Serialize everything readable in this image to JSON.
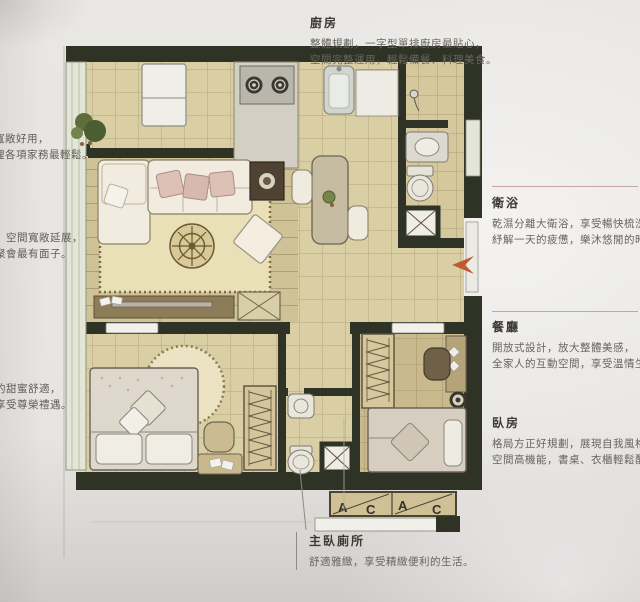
{
  "annotations": {
    "kitchen": {
      "title": "廚房",
      "line1": "整體規劃，一字型單排廚房最貼心，",
      "line2": "空間完整運用，輕鬆備餐、料理美食。"
    },
    "bathroom": {
      "title": "衛浴",
      "line1": "乾濕分離大衛浴，享受暢快梳洗，",
      "line2": "紓解一天的疲憊，樂沐悠閒的時光。"
    },
    "dining": {
      "title": "餐廳",
      "line1": "開放式設計，放大整體美感，",
      "line2": "全家人的互動空間，享受溫情生活。"
    },
    "bedroom": {
      "title": "臥房",
      "line1": "格局方正好規劃，展現自我風格，",
      "line2": "空間高機能，書桌、衣櫃輕鬆配置。"
    },
    "master_toilet": {
      "title": "主臥廁所",
      "line1": "舒適雅緻，享受精緻便利的生活。"
    },
    "left_top": {
      "line1": "寬敞好用，",
      "line2": "理各項家務最輕鬆。"
    },
    "left_middle": {
      "line1": "，空間寬敞延展，",
      "line2": "聚會最有面子。"
    },
    "left_bottom": {
      "line1": "的甜蜜舒適，",
      "line2": "享受尊榮禮遇。"
    }
  },
  "plan": {
    "ac_labels": [
      "A",
      "C",
      "A",
      "C"
    ],
    "colors": {
      "wall": "#2e3326",
      "tile": "#dacea4",
      "bath_tile": "#d6c89d",
      "wood_floor": "#cfc296",
      "rug": "#eae0b8",
      "pillow_pink": "#ddc1b7",
      "entry_arrow": "#c05a30",
      "window": "#e3e6d6",
      "divider_rule": "#c3a89f"
    }
  }
}
